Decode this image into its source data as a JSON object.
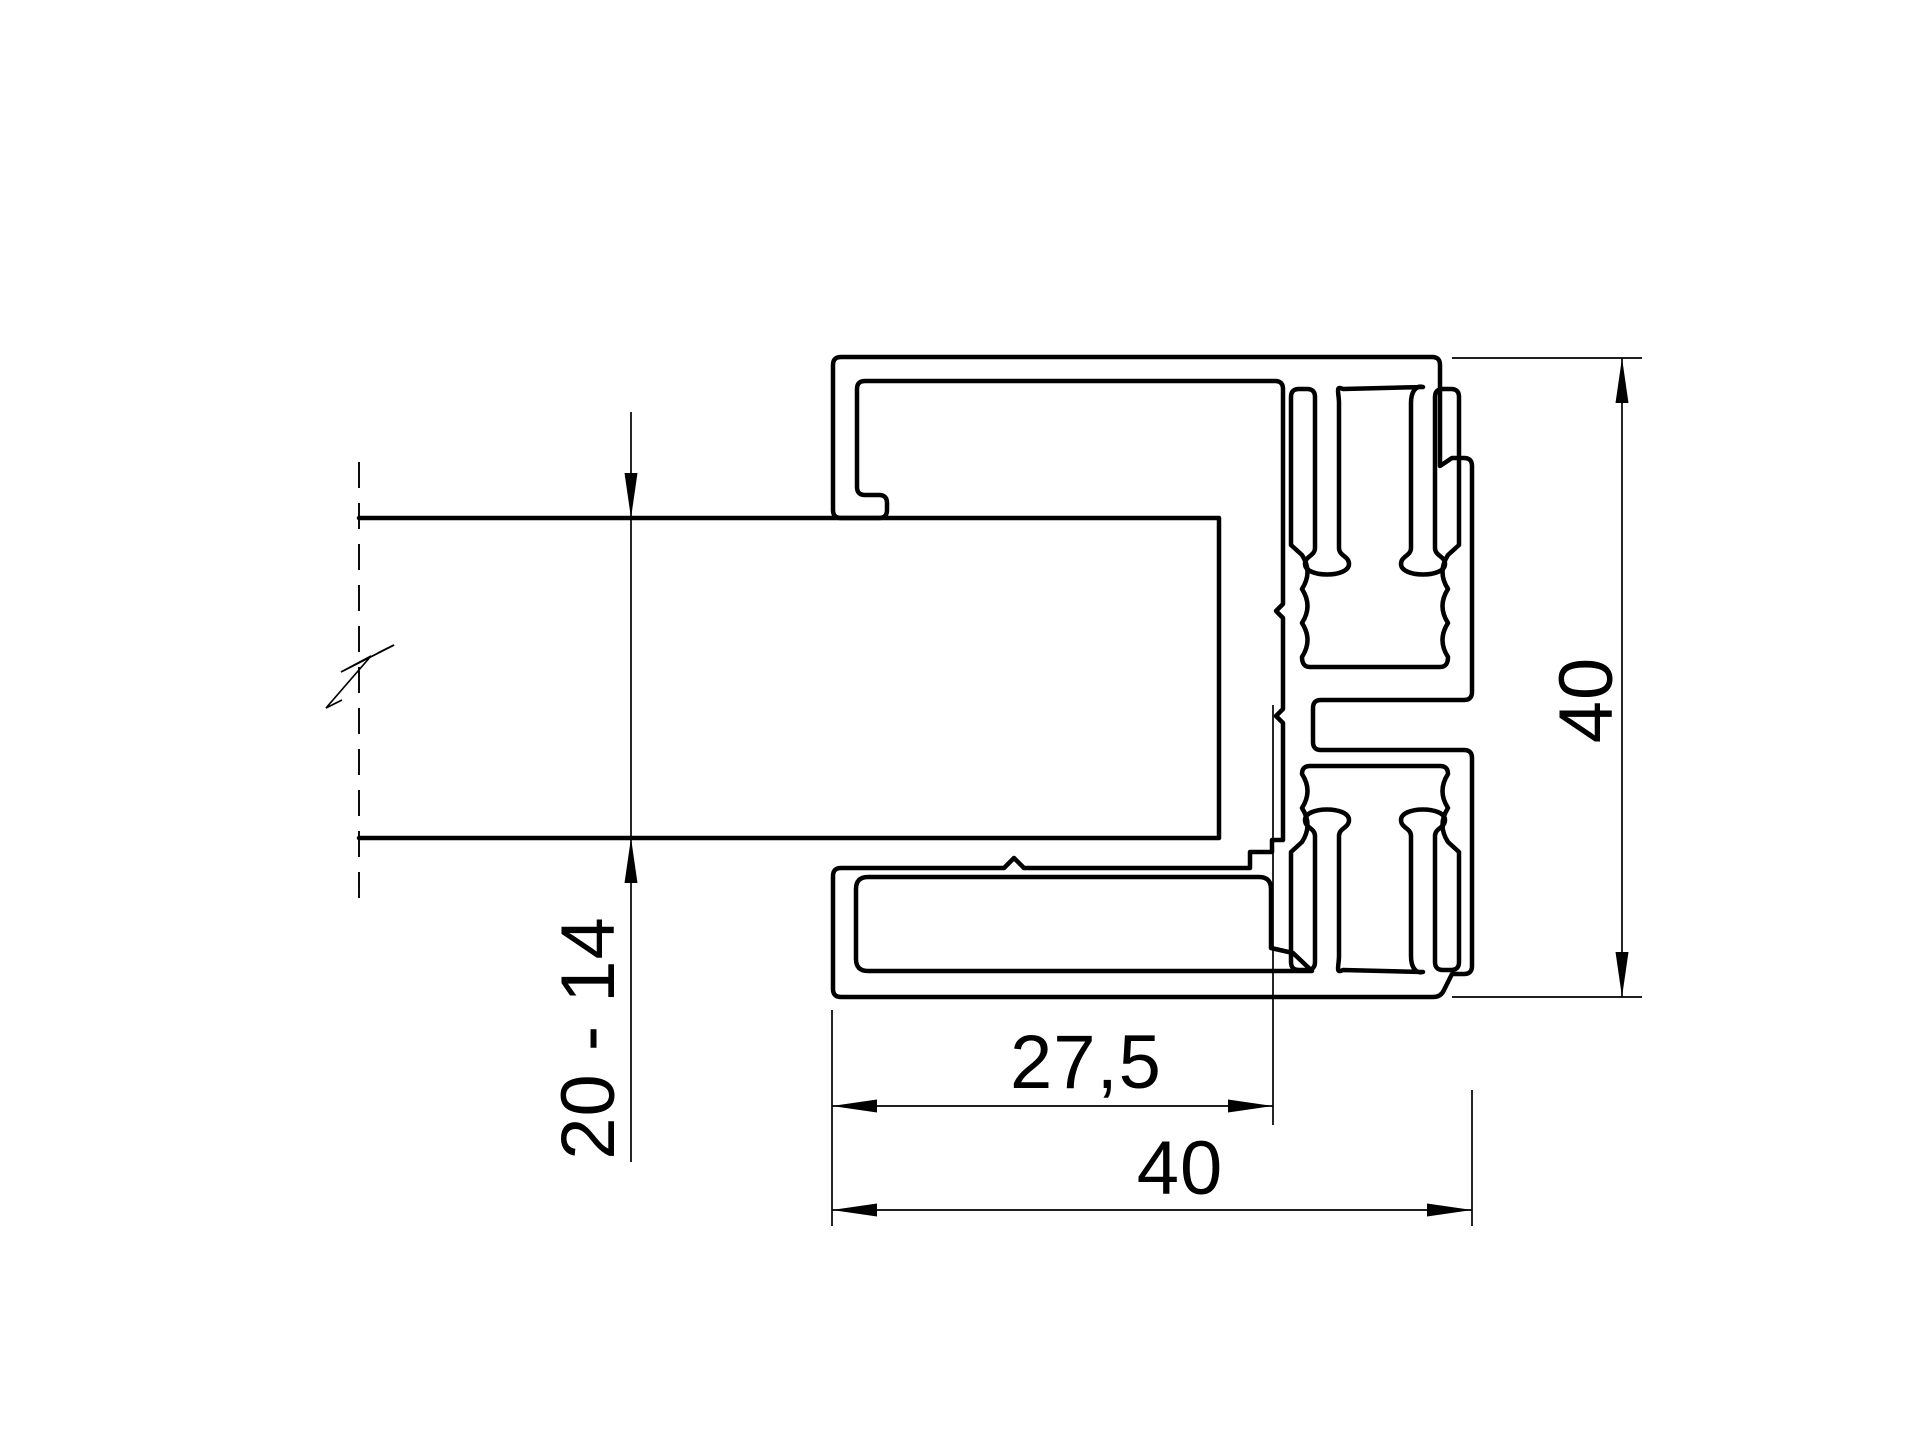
{
  "drawing": {
    "title": "Glass clamp aluminium profile cross-section",
    "type": "technical-drawing",
    "background_color": "#ffffff",
    "line_color": "#000000",
    "dimensions": {
      "glass_thickness": "20 - 14",
      "inner_depth": "27,5",
      "overall_width": "40",
      "overall_height": "40"
    }
  }
}
